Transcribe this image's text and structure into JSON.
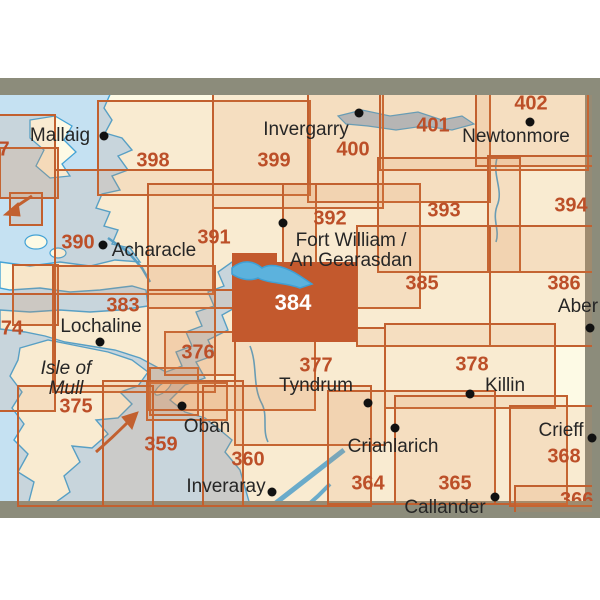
{
  "map": {
    "colors": {
      "sea": "#c5e1f2",
      "land": "#fdfae5",
      "grid_line": "#c2602f",
      "sheet_number": "#bc4f28",
      "highlight_fill": "#c3592d",
      "highlight_number": "#ffffff",
      "frame_band": "#8c8c7b",
      "water_line": "#44a3d6",
      "place_text": "#262626",
      "place_dot": "#111111"
    },
    "highlighted_sheet": "384",
    "sheets": [
      {
        "number": "7",
        "rect": [
          -70,
          115,
          125,
          83
        ],
        "label": [
          4,
          150
        ]
      },
      {
        "number": "398",
        "rect": [
          98,
          101,
          212,
          94
        ],
        "label": [
          153,
          161
        ]
      },
      {
        "number": "399",
        "rect": [
          213,
          84,
          170,
          124
        ],
        "label": [
          274,
          161
        ]
      },
      {
        "number": "400",
        "rect": [
          308,
          82,
          182,
          120
        ],
        "label": [
          353,
          150
        ]
      },
      {
        "number": "401",
        "rect": [
          380,
          94,
          208,
          76
        ],
        "label": [
          433,
          126
        ]
      },
      {
        "number": "402",
        "rect": [
          476,
          78,
          140,
          88
        ],
        "label": [
          531,
          104
        ]
      },
      {
        "number": "390",
        "rect": [
          55,
          170,
          158,
          124
        ],
        "label": [
          78,
          243
        ]
      },
      {
        "number": "391",
        "rect": [
          148,
          184,
          168,
          124
        ],
        "label": [
          214,
          238
        ]
      },
      {
        "number": "392",
        "rect": [
          283,
          184,
          137,
          124
        ],
        "label": [
          330,
          219
        ]
      },
      {
        "number": "393",
        "rect": [
          378,
          158,
          142,
          114
        ],
        "label": [
          444,
          211
        ]
      },
      {
        "number": "394",
        "rect": [
          488,
          156,
          128,
          116
        ],
        "label": [
          571,
          206
        ]
      },
      {
        "number": "383",
        "rect": [
          53,
          266,
          162,
          126
        ],
        "label": [
          123,
          306
        ]
      },
      {
        "number": "385",
        "rect": [
          357,
          226,
          133,
          120
        ],
        "label": [
          422,
          284
        ]
      },
      {
        "number": "386",
        "rect": [
          490,
          226,
          126,
          120
        ],
        "label": [
          564,
          284
        ]
      },
      {
        "number": "74",
        "rect": [
          -70,
          294,
          125,
          117
        ],
        "label": [
          12,
          329
        ]
      },
      {
        "number": "376",
        "rect": [
          148,
          290,
          167,
          120
        ],
        "label": [
          198,
          353
        ]
      },
      {
        "number": "377",
        "rect": [
          235,
          328,
          150,
          117
        ],
        "label": [
          316,
          366
        ]
      },
      {
        "number": "378",
        "rect": [
          385,
          324,
          170,
          84
        ],
        "label": [
          472,
          365
        ]
      },
      {
        "number": "375",
        "rect": [
          18,
          386,
          135,
          120
        ],
        "label": [
          76,
          407
        ]
      },
      {
        "number": "359",
        "rect": [
          103,
          381,
          140,
          125
        ],
        "label": [
          161,
          445
        ]
      },
      {
        "number": "360",
        "rect": [
          203,
          386,
          168,
          120
        ],
        "label": [
          248,
          460
        ]
      },
      {
        "number": "364",
        "rect": [
          328,
          391,
          167,
          113
        ],
        "label": [
          368,
          484
        ]
      },
      {
        "number": "365",
        "rect": [
          395,
          396,
          172,
          108
        ],
        "label": [
          455,
          484
        ]
      },
      {
        "number": "368",
        "rect": [
          510,
          406,
          120,
          100
        ],
        "label": [
          564,
          457
        ]
      },
      {
        "number": "366",
        "rect": [
          515,
          486,
          120,
          60
        ],
        "label": [
          562,
          494
        ],
        "clip": [
          560,
          492,
          46,
          9
        ]
      },
      {
        "number": "384",
        "points": [
          [
            232,
            253
          ],
          [
            277,
            253
          ],
          [
            277,
            262
          ],
          [
            357,
            262
          ],
          [
            357,
            342
          ],
          [
            232,
            342
          ]
        ],
        "label": [
          293,
          303
        ]
      }
    ],
    "overlap_cells": [
      [
        0,
        148,
        58,
        50
      ],
      [
        10,
        193,
        32,
        32
      ],
      [
        147,
        383,
        80,
        37
      ],
      [
        150,
        368,
        48,
        47
      ],
      [
        165,
        332,
        70,
        43
      ],
      [
        13,
        265,
        45,
        60
      ]
    ],
    "places": [
      {
        "name": "Mallaig",
        "x": 60,
        "y": 136,
        "dot": [
          104,
          136
        ]
      },
      {
        "name": "Invergarry",
        "x": 306,
        "y": 130,
        "dot": [
          359,
          113
        ]
      },
      {
        "name": "Newtonmore",
        "x": 516,
        "y": 137,
        "dot": [
          530,
          122
        ]
      },
      {
        "name": "Acharacle",
        "x": 154,
        "y": 251,
        "dot": [
          103,
          245
        ]
      },
      {
        "name": "Fort William /\nAn Gearasdan",
        "x": 351,
        "y": 251,
        "dot": [
          283,
          223
        ]
      },
      {
        "name": "Lochaline",
        "x": 101,
        "y": 327,
        "dot": [
          100,
          342
        ]
      },
      {
        "name": "Aber",
        "x": 578,
        "y": 307,
        "dot": [
          590,
          328
        ]
      },
      {
        "name": "Isle of\nMull",
        "x": 66,
        "y": 379,
        "italic": true
      },
      {
        "name": "Tyndrum",
        "x": 316,
        "y": 386
      },
      {
        "name": "Killin",
        "x": 505,
        "y": 386,
        "dot": [
          470,
          394
        ]
      },
      {
        "name": "Oban",
        "x": 207,
        "y": 427,
        "dot": [
          182,
          406
        ]
      },
      {
        "name": "Inveraray",
        "x": 226,
        "y": 487,
        "dot": [
          272,
          492
        ]
      },
      {
        "name": "Crianlarich",
        "x": 393,
        "y": 447,
        "dot": [
          395,
          428
        ]
      },
      {
        "name": "Callander",
        "x": 445,
        "y": 508,
        "dot": [
          495,
          497
        ]
      },
      {
        "name": "Crieff",
        "x": 561,
        "y": 431,
        "dot": [
          592,
          438
        ]
      }
    ],
    "extra_dots": [
      [
        368,
        403
      ]
    ]
  }
}
